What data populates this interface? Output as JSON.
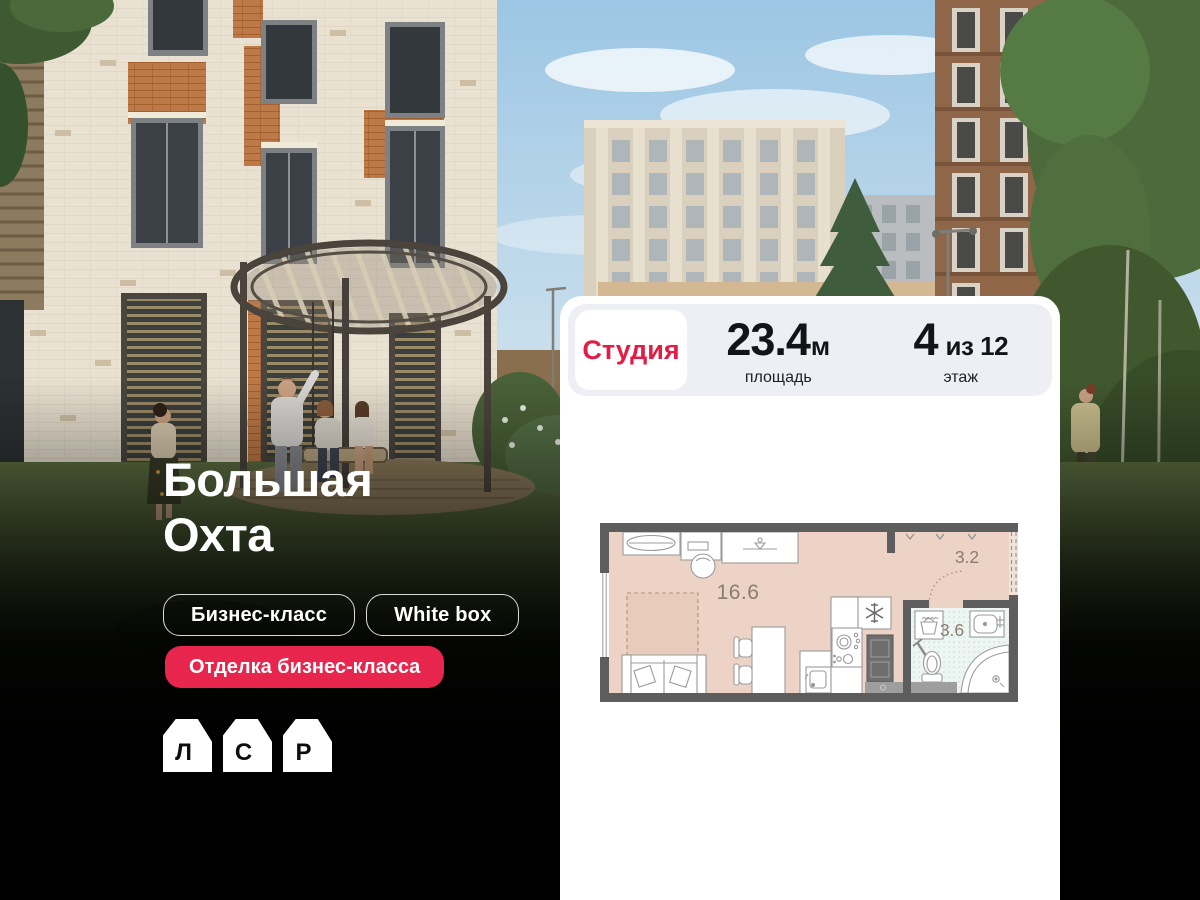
{
  "hero": {
    "title": {
      "line1": "Большая",
      "line2": "Охта"
    },
    "tags": [
      {
        "label": "Бизнес-класс"
      },
      {
        "label": "White box"
      }
    ],
    "promo_tag": {
      "label": "Отделка бизнес-класса"
    },
    "logo": {
      "letters": [
        "Л",
        "С",
        "Р"
      ]
    }
  },
  "card": {
    "type_label": "Студия",
    "area": {
      "value": "23.4",
      "unit": "м",
      "caption": "площадь"
    },
    "floor": {
      "value": "4",
      "suffix": "из 12",
      "caption": "этаж"
    },
    "plan": {
      "labels": {
        "room": "16.6",
        "hall": "3.2",
        "bath": "3.6"
      }
    }
  },
  "colors": {
    "accent_red": "#e31c45",
    "promo_red": "#e8254c",
    "card_bg": "#ffffff",
    "panel_bg": "#edeff4",
    "plan_wall": "#5d5d5d",
    "plan_floor": "#ecd3c5",
    "plan_bath_tile": "#eef6f3"
  }
}
